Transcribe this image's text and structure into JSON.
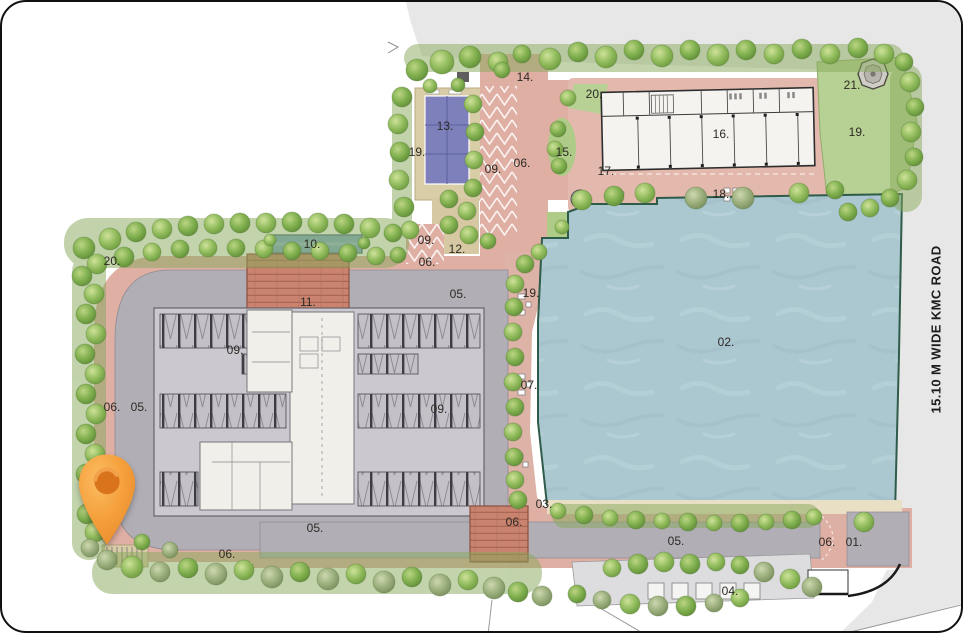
{
  "site_plan": {
    "road_label": "15.10 M WIDE KMC ROAD",
    "marker": {
      "type": "location-pin",
      "color": "#F49C38"
    },
    "labels": [
      {
        "id": "01",
        "text": "01.",
        "x": 852,
        "y": 540
      },
      {
        "id": "02",
        "text": "02.",
        "x": 724,
        "y": 340
      },
      {
        "id": "03",
        "text": "03.",
        "x": 542,
        "y": 502
      },
      {
        "id": "04",
        "text": "04.",
        "x": 728,
        "y": 589
      },
      {
        "id": "05-a",
        "text": "05.",
        "x": 456,
        "y": 292
      },
      {
        "id": "05-b",
        "text": "05.",
        "x": 137,
        "y": 405
      },
      {
        "id": "05-c",
        "text": "05.",
        "x": 313,
        "y": 526
      },
      {
        "id": "05-d",
        "text": "05.",
        "x": 674,
        "y": 539
      },
      {
        "id": "06-a",
        "text": "06.",
        "x": 520,
        "y": 161
      },
      {
        "id": "06-b",
        "text": "06.",
        "x": 425,
        "y": 260
      },
      {
        "id": "06-c",
        "text": "06.",
        "x": 110,
        "y": 405
      },
      {
        "id": "06-d",
        "text": "06.",
        "x": 225,
        "y": 552
      },
      {
        "id": "06-e",
        "text": "06.",
        "x": 512,
        "y": 520
      },
      {
        "id": "06-f",
        "text": "06.",
        "x": 825,
        "y": 540
      },
      {
        "id": "07",
        "text": "07.",
        "x": 527,
        "y": 383
      },
      {
        "id": "09-a",
        "text": "09.",
        "x": 491,
        "y": 167
      },
      {
        "id": "09-b",
        "text": "09.",
        "x": 424,
        "y": 238
      },
      {
        "id": "09-c",
        "text": "09.",
        "x": 233,
        "y": 348
      },
      {
        "id": "09-d",
        "text": "09.",
        "x": 437,
        "y": 407
      },
      {
        "id": "10",
        "text": "10.",
        "x": 310,
        "y": 242
      },
      {
        "id": "11",
        "text": "11.",
        "x": 306,
        "y": 300
      },
      {
        "id": "12",
        "text": "12.",
        "x": 455,
        "y": 247
      },
      {
        "id": "13",
        "text": "13.",
        "x": 443,
        "y": 124
      },
      {
        "id": "14",
        "text": "14.",
        "x": 523,
        "y": 75
      },
      {
        "id": "15",
        "text": "15.",
        "x": 562,
        "y": 150
      },
      {
        "id": "16",
        "text": "16.",
        "x": 719,
        "y": 132
      },
      {
        "id": "17",
        "text": "17.",
        "x": 604,
        "y": 169
      },
      {
        "id": "18",
        "text": "18.",
        "x": 719,
        "y": 192
      },
      {
        "id": "19-a",
        "text": "19.",
        "x": 415,
        "y": 150
      },
      {
        "id": "19-b",
        "text": "19.",
        "x": 855,
        "y": 130
      },
      {
        "id": "19-c",
        "text": "19.",
        "x": 529,
        "y": 291
      },
      {
        "id": "20-a",
        "text": "20.",
        "x": 110,
        "y": 259
      },
      {
        "id": "20-b",
        "text": "20.",
        "x": 592,
        "y": 92
      },
      {
        "id": "21",
        "text": "21.",
        "x": 850,
        "y": 83
      }
    ],
    "colors": {
      "water": "#ABC7D0",
      "path_pink": "#DFAFA4",
      "road_gray": "#B1AFB5",
      "court_purple": "#7D80BA",
      "lawn_green": "#B7D093",
      "tree_green": "#8FB95C",
      "brick": "#C9836F",
      "pin_orange": "#F49C38",
      "outside_road": "#E8E7E7"
    }
  }
}
